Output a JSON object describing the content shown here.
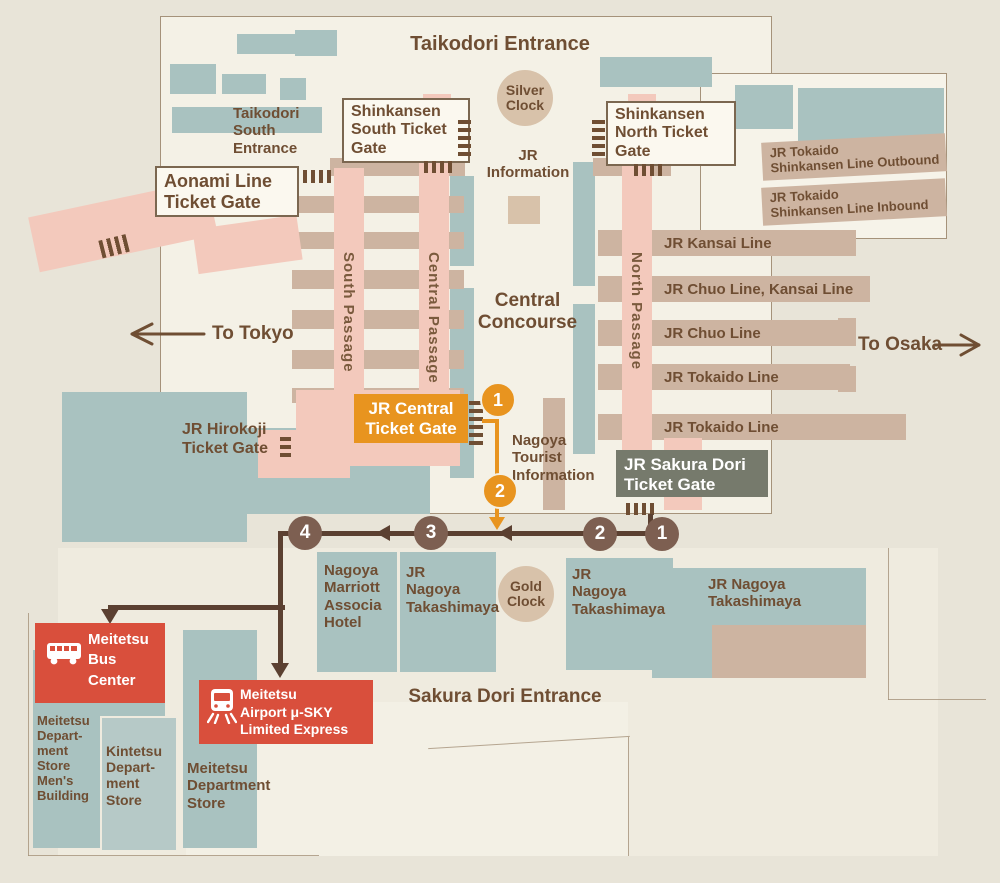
{
  "entrances": {
    "taikodori": "Taikodori Entrance",
    "taikodori_south": "Taikodori\nSouth\nEntrance",
    "sakura_dori": "Sakura Dori Entrance"
  },
  "clocks": {
    "silver": "Silver\nClock",
    "gold": "Gold\nClock"
  },
  "gates": {
    "shinkansen_south": "Shinkansen\nSouth Ticket\nGate",
    "shinkansen_north": "Shinkansen\nNorth Ticket\nGate",
    "aonami": "Aonami Line\nTicket Gate",
    "jr_central": "JR Central\nTicket Gate",
    "jr_sakura_dori": "JR Sakura Dori\nTicket Gate",
    "jr_hirokoji": "JR Hirokoji\nTicket Gate"
  },
  "concourse": {
    "jr_information": "JR\nInformation",
    "central_concourse": "Central\nConcourse",
    "tourist_information": "Nagoya\nTourist\nInformation"
  },
  "passages": {
    "south": "South Passage",
    "central": "Central Passage",
    "north": "North Passage"
  },
  "directions": {
    "to_tokyo": "To Tokyo",
    "to_osaka": "To Osaka"
  },
  "shinkansen_lines": [
    "JR Tokaido\nShinkansen Line Outbound",
    "JR Tokaido\nShinkansen Line Inbound"
  ],
  "platforms": [
    "JR Kansai Line",
    "JR Chuo Line, Kansai Line",
    "JR Chuo Line",
    "JR Tokaido Line",
    "JR Tokaido Line"
  ],
  "buildings": {
    "marriott_hotel": "Nagoya\nMarriott\nAssocia\nHotel",
    "takashimaya_left": "JR\nNagoya\nTakashimaya",
    "takashimaya_mid": "JR\nNagoya\nTakashimaya",
    "takashimaya_right": "JR Nagoya\nTakashimaya",
    "meitetsu_bus_center": "Meitetsu\nBus\nCenter",
    "meitetsu_airport_express": "Meitetsu\nAirport μ-SKY\nLimited Express",
    "meitetsu_dept_mens": "Meitetsu\nDepart-\nment\nStore\nMen's\nBuilding",
    "kintetsu_dept": "Kintetsu\nDepart-\nment\nStore",
    "meitetsu_dept": "Meitetsu\nDepartment\nStore"
  },
  "route_markers": {
    "orange": [
      "1",
      "2"
    ],
    "brown": [
      "1",
      "2",
      "3",
      "4"
    ]
  },
  "icons": {
    "bus": "bus-icon",
    "train": "train-icon"
  },
  "colors": {
    "route_brown": "#5B4031",
    "marker_orange": "#E8941F",
    "highlight_red": "#D94F3C",
    "gate_gray": "#767A6C",
    "building_teal": "#A9C2C0",
    "passage_pink": "#F3C9BC",
    "platform_tan": "#CDB4A1",
    "label_brown": "#6F4E33"
  }
}
